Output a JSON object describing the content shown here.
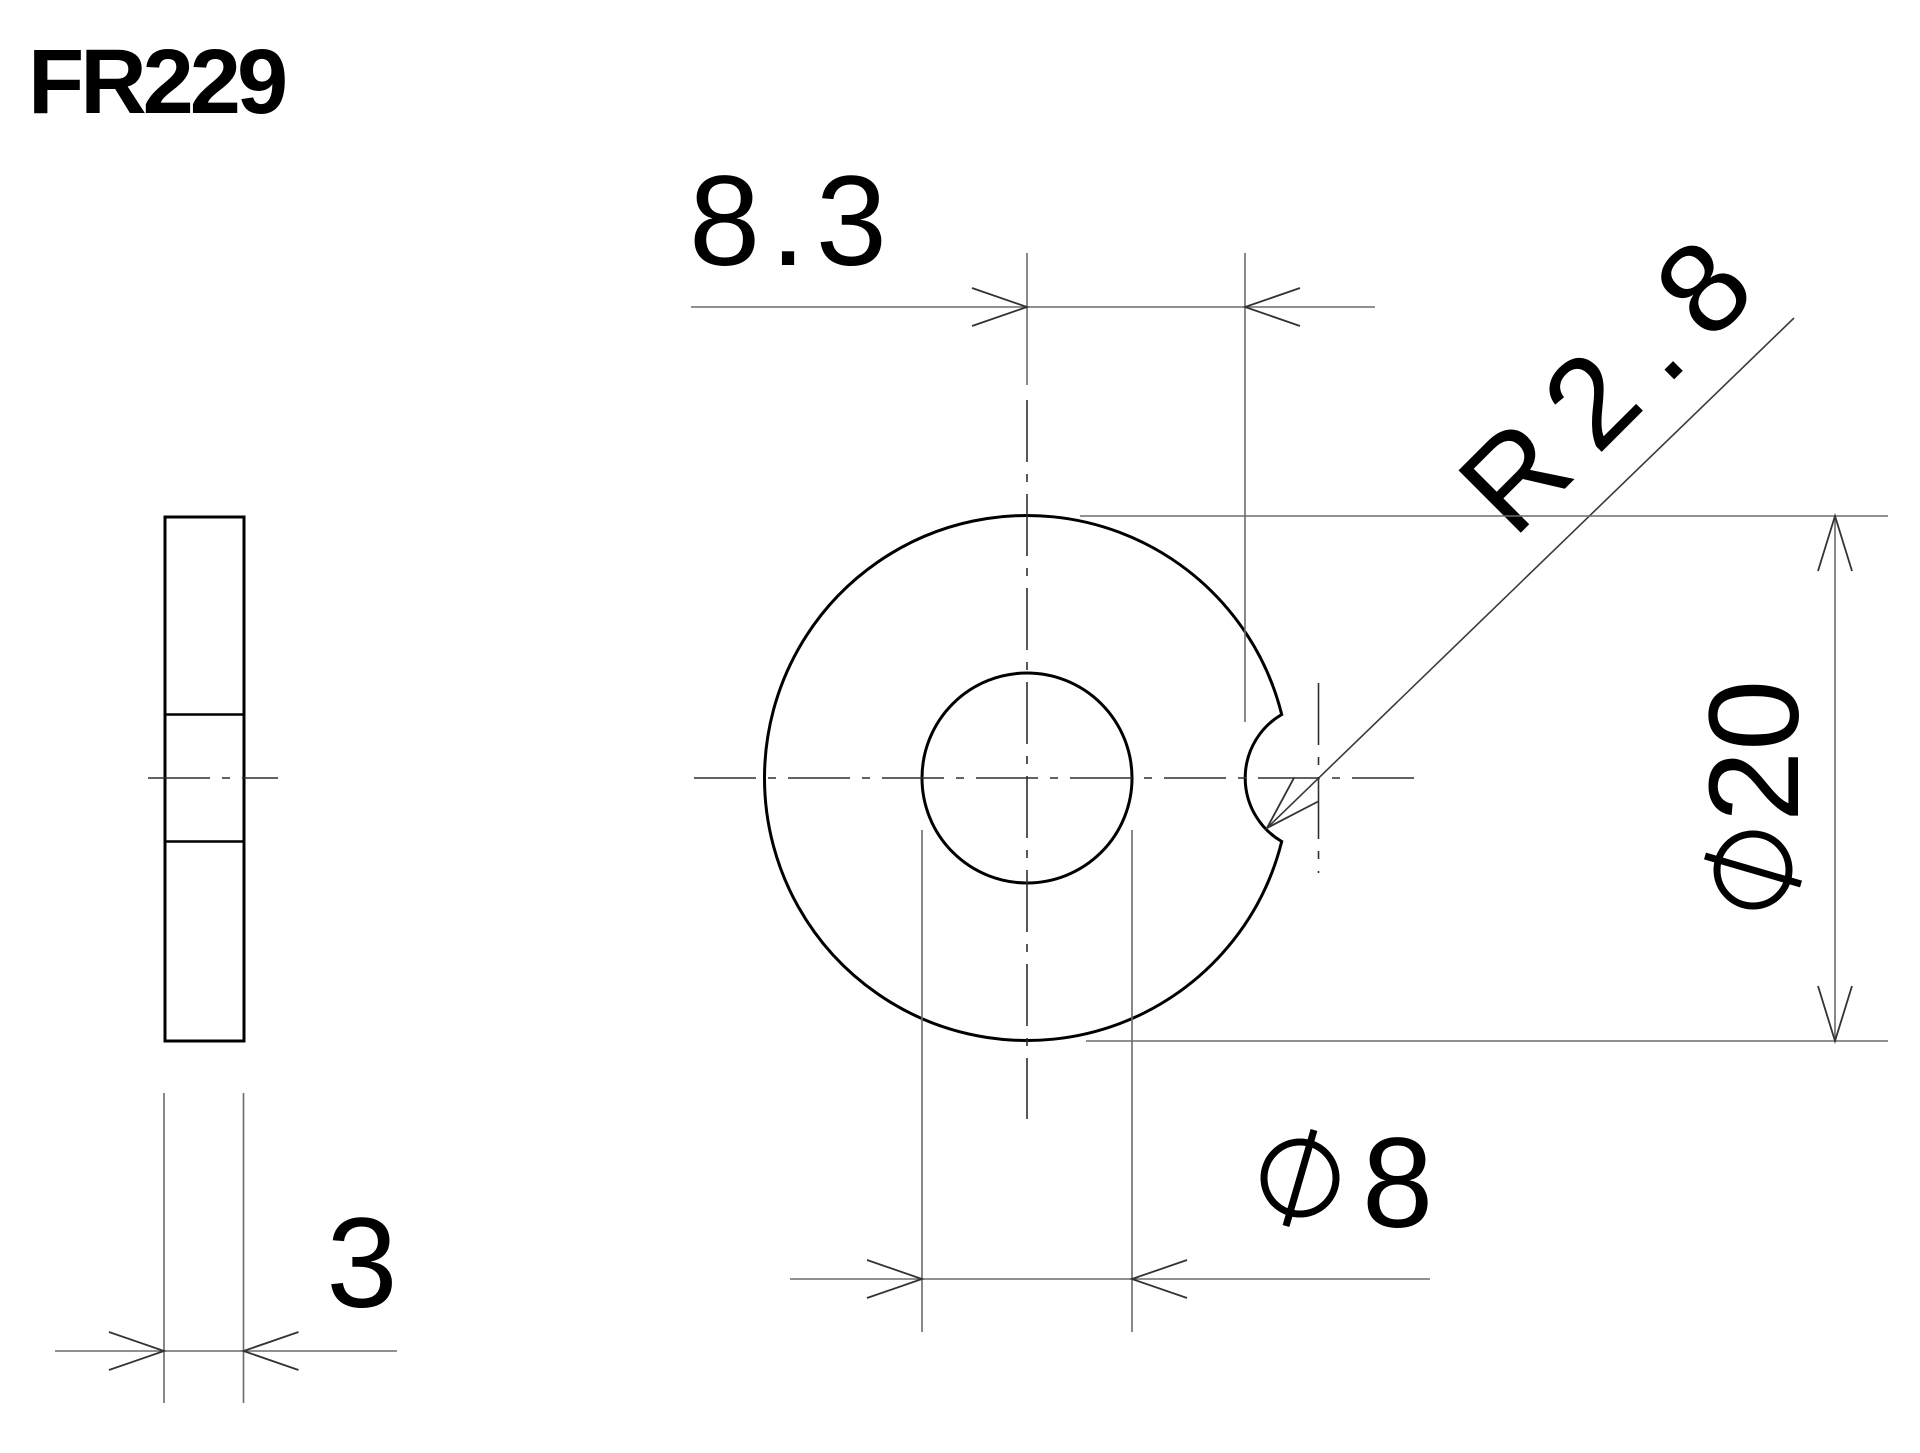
{
  "title": "FR229",
  "drawing_type": "engineering-part-drawing",
  "part": {
    "outer_diameter_mm": 20,
    "hole_diameter_mm": 8,
    "notch_radius_mm": 2.8,
    "notch_offset_from_center_mm": 8.3,
    "thickness_mm": 3
  },
  "views": {
    "side_view": {
      "name": "side view (thickness)"
    },
    "front_view": {
      "name": "front view (washer with notch)"
    }
  },
  "dimensions": {
    "offset": {
      "label": "8.3",
      "value": 8.3,
      "kind": "linear-horizontal"
    },
    "notch_radius": {
      "label": "R2.8",
      "value": 2.8,
      "kind": "radius-leader"
    },
    "outer_diameter": {
      "label": "φ20",
      "digits": "20",
      "value": 20,
      "kind": "diameter-vertical"
    },
    "hole_diameter": {
      "label": "φ8",
      "digits": "8",
      "value": 8,
      "kind": "diameter-horizontal"
    },
    "thickness": {
      "label": "3",
      "value": 3,
      "kind": "linear-horizontal"
    }
  },
  "symbols": {
    "diameter_symbol": "circle-with-slash (⌀)"
  },
  "colors": {
    "background": "#ffffff",
    "outline": "#000000",
    "thin_line": "#6b6b6b",
    "centerline": "#2e2e2e",
    "text": "#000000"
  }
}
